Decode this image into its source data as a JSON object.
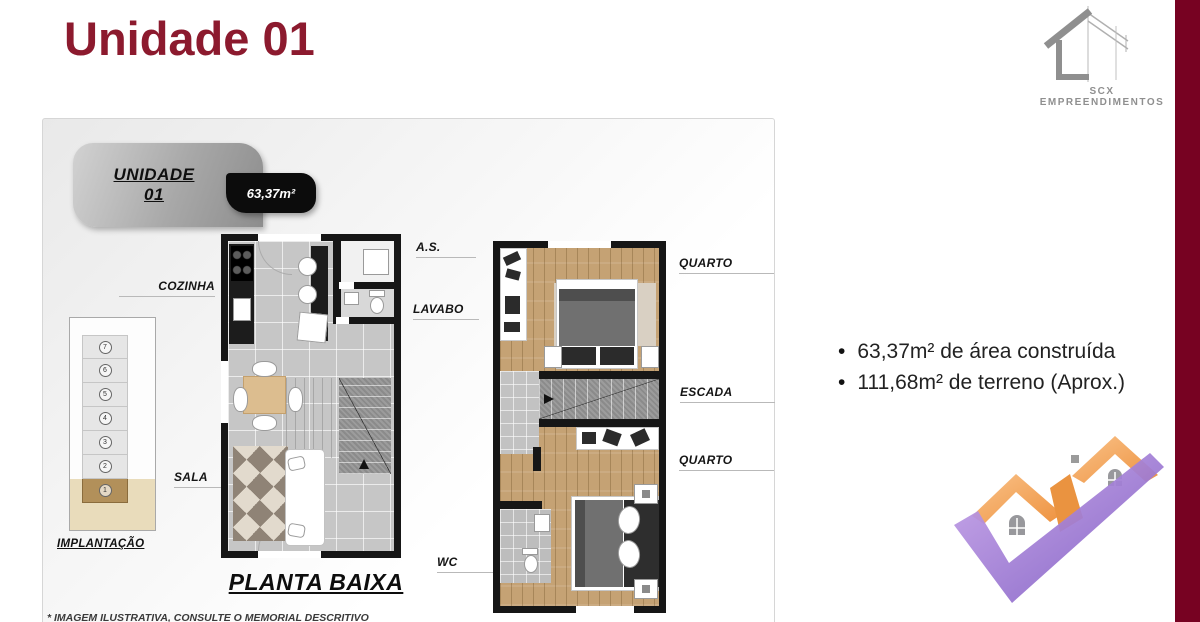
{
  "title": "Unidade 01",
  "brand": {
    "name": "SCX EMPREENDIMENTOS"
  },
  "badge": {
    "line1": "UNIDADE",
    "line2": "01",
    "area": "63,37m²"
  },
  "implantacao": {
    "label": "IMPLANTAÇÃO",
    "units": [
      "7",
      "6",
      "5",
      "4",
      "3",
      "2",
      "1"
    ]
  },
  "labels": {
    "cozinha": "COZINHA",
    "as": "A.S.",
    "lavabo": "LAVABO",
    "sala": "SALA",
    "wc": "WC",
    "quarto_sup": "QUARTO",
    "escada": "ESCADA",
    "quarto_inf": "QUARTO"
  },
  "plan_title": "PLANTA BAIXA",
  "features": {
    "items": [
      "63,37m² de área construída",
      "111,68m² de terreno (Aprox.)"
    ]
  },
  "disclaimer": "* IMAGEM ILUSTRATIVA, CONSULTE O MEMORIAL DESCRITIVO",
  "colors": {
    "accent": "#8C1A2E",
    "band": "#770222",
    "roof_orange": "#F09C4F",
    "check_purple": "#8A66C9"
  }
}
